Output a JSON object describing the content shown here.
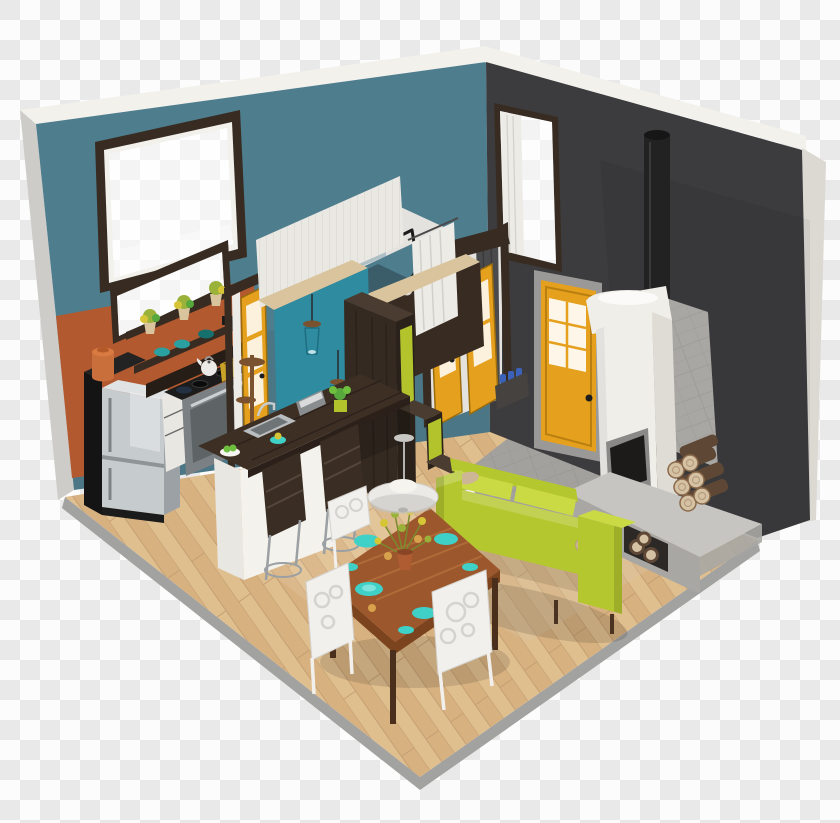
{
  "scene": {
    "title": "3D isometric cutaway render of a tiny house interior on a transparent checkerboard background",
    "type": "isometric-interior-render",
    "background": "transparency-checkerboard",
    "rooms": [
      "kitchen",
      "bathroom",
      "dining-area",
      "living-area",
      "entry-hall"
    ],
    "objects": [
      "left-wall",
      "right-wall",
      "big-window",
      "tall-window",
      "kitchen-window",
      "entry-door",
      "french-doors",
      "interior-door",
      "bathroom-cube",
      "mirror",
      "shower-curtain",
      "wall-lamp",
      "stair-storage-cabinet",
      "kitchen-shelves",
      "refrigerator",
      "stove",
      "black-cabinet",
      "canister",
      "kettle",
      "toaster",
      "kitchen-island",
      "sink",
      "bar-stools",
      "pendant-lamps",
      "coat-stand",
      "ufo-pendant-lamp",
      "fireplace",
      "stovepipe",
      "hearth-bench",
      "firewood",
      "sofa",
      "throw-pillows",
      "rug",
      "dining-table",
      "dining-chairs",
      "teal-plates",
      "flower-centerpiece",
      "wood-floor",
      "concrete-floor",
      "planter-box",
      "blue-bowls",
      "potted-plants"
    ]
  },
  "colors": {
    "checker_light": "#fcfcfc",
    "checker_dark": "#e9e9e9",
    "trim_white": "#f2f1ec",
    "edge_gray": "#cdccc9",
    "edge_cream": "#dcd9d3",
    "wall_teal": "#4e7d8d",
    "wall_dark": "#3c3c3e",
    "wall_orange": "#b3592f",
    "floor_wood": "#dfbb88",
    "floor_wood2": "#d6ad79",
    "floor_wood_line": "#c19a6b",
    "floor_edge": "#a2a2a0",
    "concrete": "#a3a19d",
    "concrete_line": "#8f8d89",
    "tile_gray": "#a9a7a3",
    "espresso": "#382c22",
    "espresso_dark": "#261d16",
    "wood_mid": "#7a5230",
    "door_yellow": "#e5a01e",
    "door_yellow_dark": "#b97f10",
    "frame_gray": "#9b9997",
    "accent_teal": "#2e8ba0",
    "shiplap": "#eae8e3",
    "shiplap_line": "#d8d5cf",
    "cap_tan": "#d9c49e",
    "interior_wall": "#e4e2de",
    "chartreuse": "#b2c32c",
    "sofa_green": "#b5c72f",
    "sofa_green_light": "#cada45",
    "pillow_tan": "#cdb695",
    "fire_white": "#f0eee9",
    "fire_shade": "#dfdcd6",
    "pipe_black": "#222222",
    "bench_top": "#c7c5c1",
    "bench_front": "#a9a7a3",
    "firebox_dark": "#1d1b19",
    "firebox_frame": "#8b8987",
    "log_brown": "#5f4735",
    "log_end": "#d5c1a4",
    "table_wood": "#9c582c",
    "table_wood_dark": "#7b441f",
    "table_grain": "#b5703d",
    "chair_white": "#f2f0ec",
    "chair_line": "#d5d3cf",
    "plate_teal": "#3fd0c8",
    "plate_teal_light": "#7ce4dc",
    "cup_amber": "#d8a24c",
    "flower_yellow": "#d6c637",
    "flower_green": "#9ab23a",
    "pot_terracotta": "#b05c33",
    "fridge_steel": "#c6cbce",
    "fridge_light": "#dfe3e4",
    "fridge_dark": "#9ba1a4",
    "appliance_gray": "#7b8084",
    "appliance_dark": "#5e6366",
    "counter_white": "#e9e7e2",
    "hardware_gray": "#6a6a6a",
    "black_cabinet": "#141414",
    "black_cabinet_top": "#232323",
    "canister_orange": "#c86f3c",
    "canister_orange_light": "#d87a42",
    "sink_steel": "#b9bdbf",
    "sink_dark": "#6f7476",
    "metal_gray": "#9aa0a3",
    "plant_green": "#6fbf3f",
    "leaf_green": "#57a83c",
    "bowl_teal": "#2aa0a0",
    "toaster_gold": "#c9a227",
    "mirror_blue": "#aebfc6",
    "curtain_white": "#edebe6",
    "curtain_fold": "#d2d0cb",
    "curtain_dark": "#4a4a4c",
    "lamp_white": "#eceae6",
    "lamp_gray": "#c3c1bd",
    "bulb_white": "#f6f4ee",
    "bottle_blue": "#3b62b8",
    "planter_dark": "#45423f"
  }
}
